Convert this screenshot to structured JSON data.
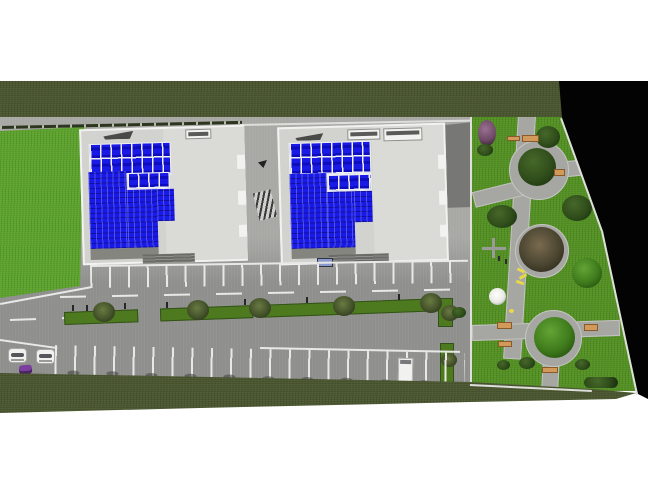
{
  "scene": {
    "type": "3d-architectural-site-plan-render",
    "description": "Top-down 3D render of a residential complex: two apartment blocks with blue glazed roofs, front parking lots with landscaped medians, and a landscaped garden with three circular plazas on the right",
    "buildings": {
      "count": 2,
      "roof_features": [
        "blue-panel-skylight-grid",
        "solid-blue-glazing",
        "roof-vents",
        "entrance-canopy"
      ]
    },
    "parking": {
      "rows": 2,
      "top_row_spaces": 20,
      "bottom_row_spaces": 21,
      "median_strips": 3,
      "median_trees": 7
    },
    "garden": {
      "circular_plazas": 3,
      "benches": 7,
      "playground_items": [
        "helicopter-toy",
        "white-dome",
        "yellow-slide"
      ],
      "trees": 9
    },
    "vehicles": {
      "white_cars": 2,
      "purple_cars": 1,
      "white_vans": 1
    }
  },
  "colors": {
    "page": "#ffffff",
    "grass-dark": "#49552e",
    "lawn": "#5ca32c",
    "garden-grass": "#529122",
    "asphalt": "#8f8f8d",
    "concrete": "#a8a8a5",
    "road-line": "#e8e8e6",
    "building-wall": "#d2d2ce",
    "building-roof-light": "#dadad6",
    "parapet": "#f2f2f0",
    "glass-blue": "#1a1ae6",
    "glass-deep": "#0d0dbd",
    "panel-frame": "#eef0f2",
    "void-black": "#030303",
    "path-grey": "#a6a6a3",
    "median-green": "#4d7a1e",
    "tree-dark": "#2f4d1a",
    "tree-green": "#3e7a1c",
    "tree-olive": "#44522a",
    "tree-purple": "#6f4968",
    "bench-tan": "#d29a5a",
    "car-white": "#f1f1ef",
    "car-purple": "#7b3fa0",
    "shadow-grey": "#6f6f6c",
    "fence-white": "#dededa",
    "vent-dark": "#4a4a48",
    "sign-blue": "#8899cc",
    "dome-white": "#e8e8e4",
    "squiggle-yellow": "#e8d84a"
  }
}
